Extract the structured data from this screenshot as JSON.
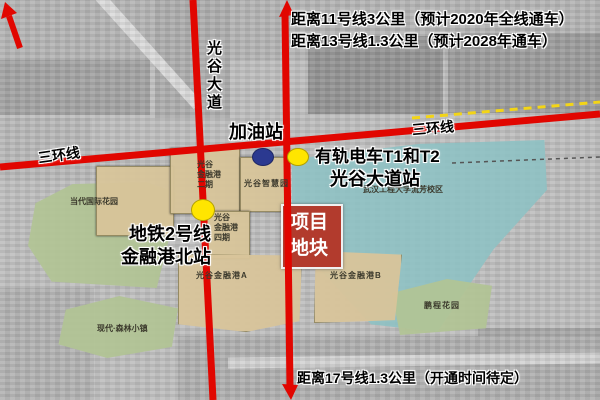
{
  "notes": {
    "line11": "距离11号线3公里（预计2020年全线通车）",
    "line13": "距离13号线1.3公里（预计2028年通车）",
    "line17": "距离17号线1.3公里（开通时间待定）"
  },
  "roads": {
    "ring_label_left": "三环线",
    "ring_label_right": "三环线",
    "avenue_label": "光谷大道",
    "road_color": "#e10600",
    "tram_line_color": "#f3d516"
  },
  "stations": {
    "gas": {
      "label": "加油站",
      "color": "#2b3990"
    },
    "tram": {
      "line1": "有轨电车T1和T2",
      "line2": "光谷大道站",
      "color": "#ffe500"
    },
    "metro": {
      "line1": "地铁2号线",
      "line2": "金融港北站",
      "color": "#ffe500"
    }
  },
  "project": {
    "label": "项目\n地块",
    "color": "#b23b2d"
  },
  "zones": {
    "dangdai_garden": "当代国际花园",
    "forest_town": "现代·森林小镇",
    "university": "武汉工程大学流芳校区",
    "pengcheng_garden": "鹏程花园",
    "financial_port_p2": "光谷\n金融港\n二期",
    "wisdom_park": "光谷智慧园",
    "financial_port_p4": "光谷\n金融港\n四期",
    "financial_port_a": "光谷金融港A",
    "financial_port_b": "光谷金融港B"
  },
  "zone_colors": {
    "residential_green": "#b2c495",
    "campus_teal": "#8ec2c4",
    "business_tan": "#d8c59a"
  }
}
